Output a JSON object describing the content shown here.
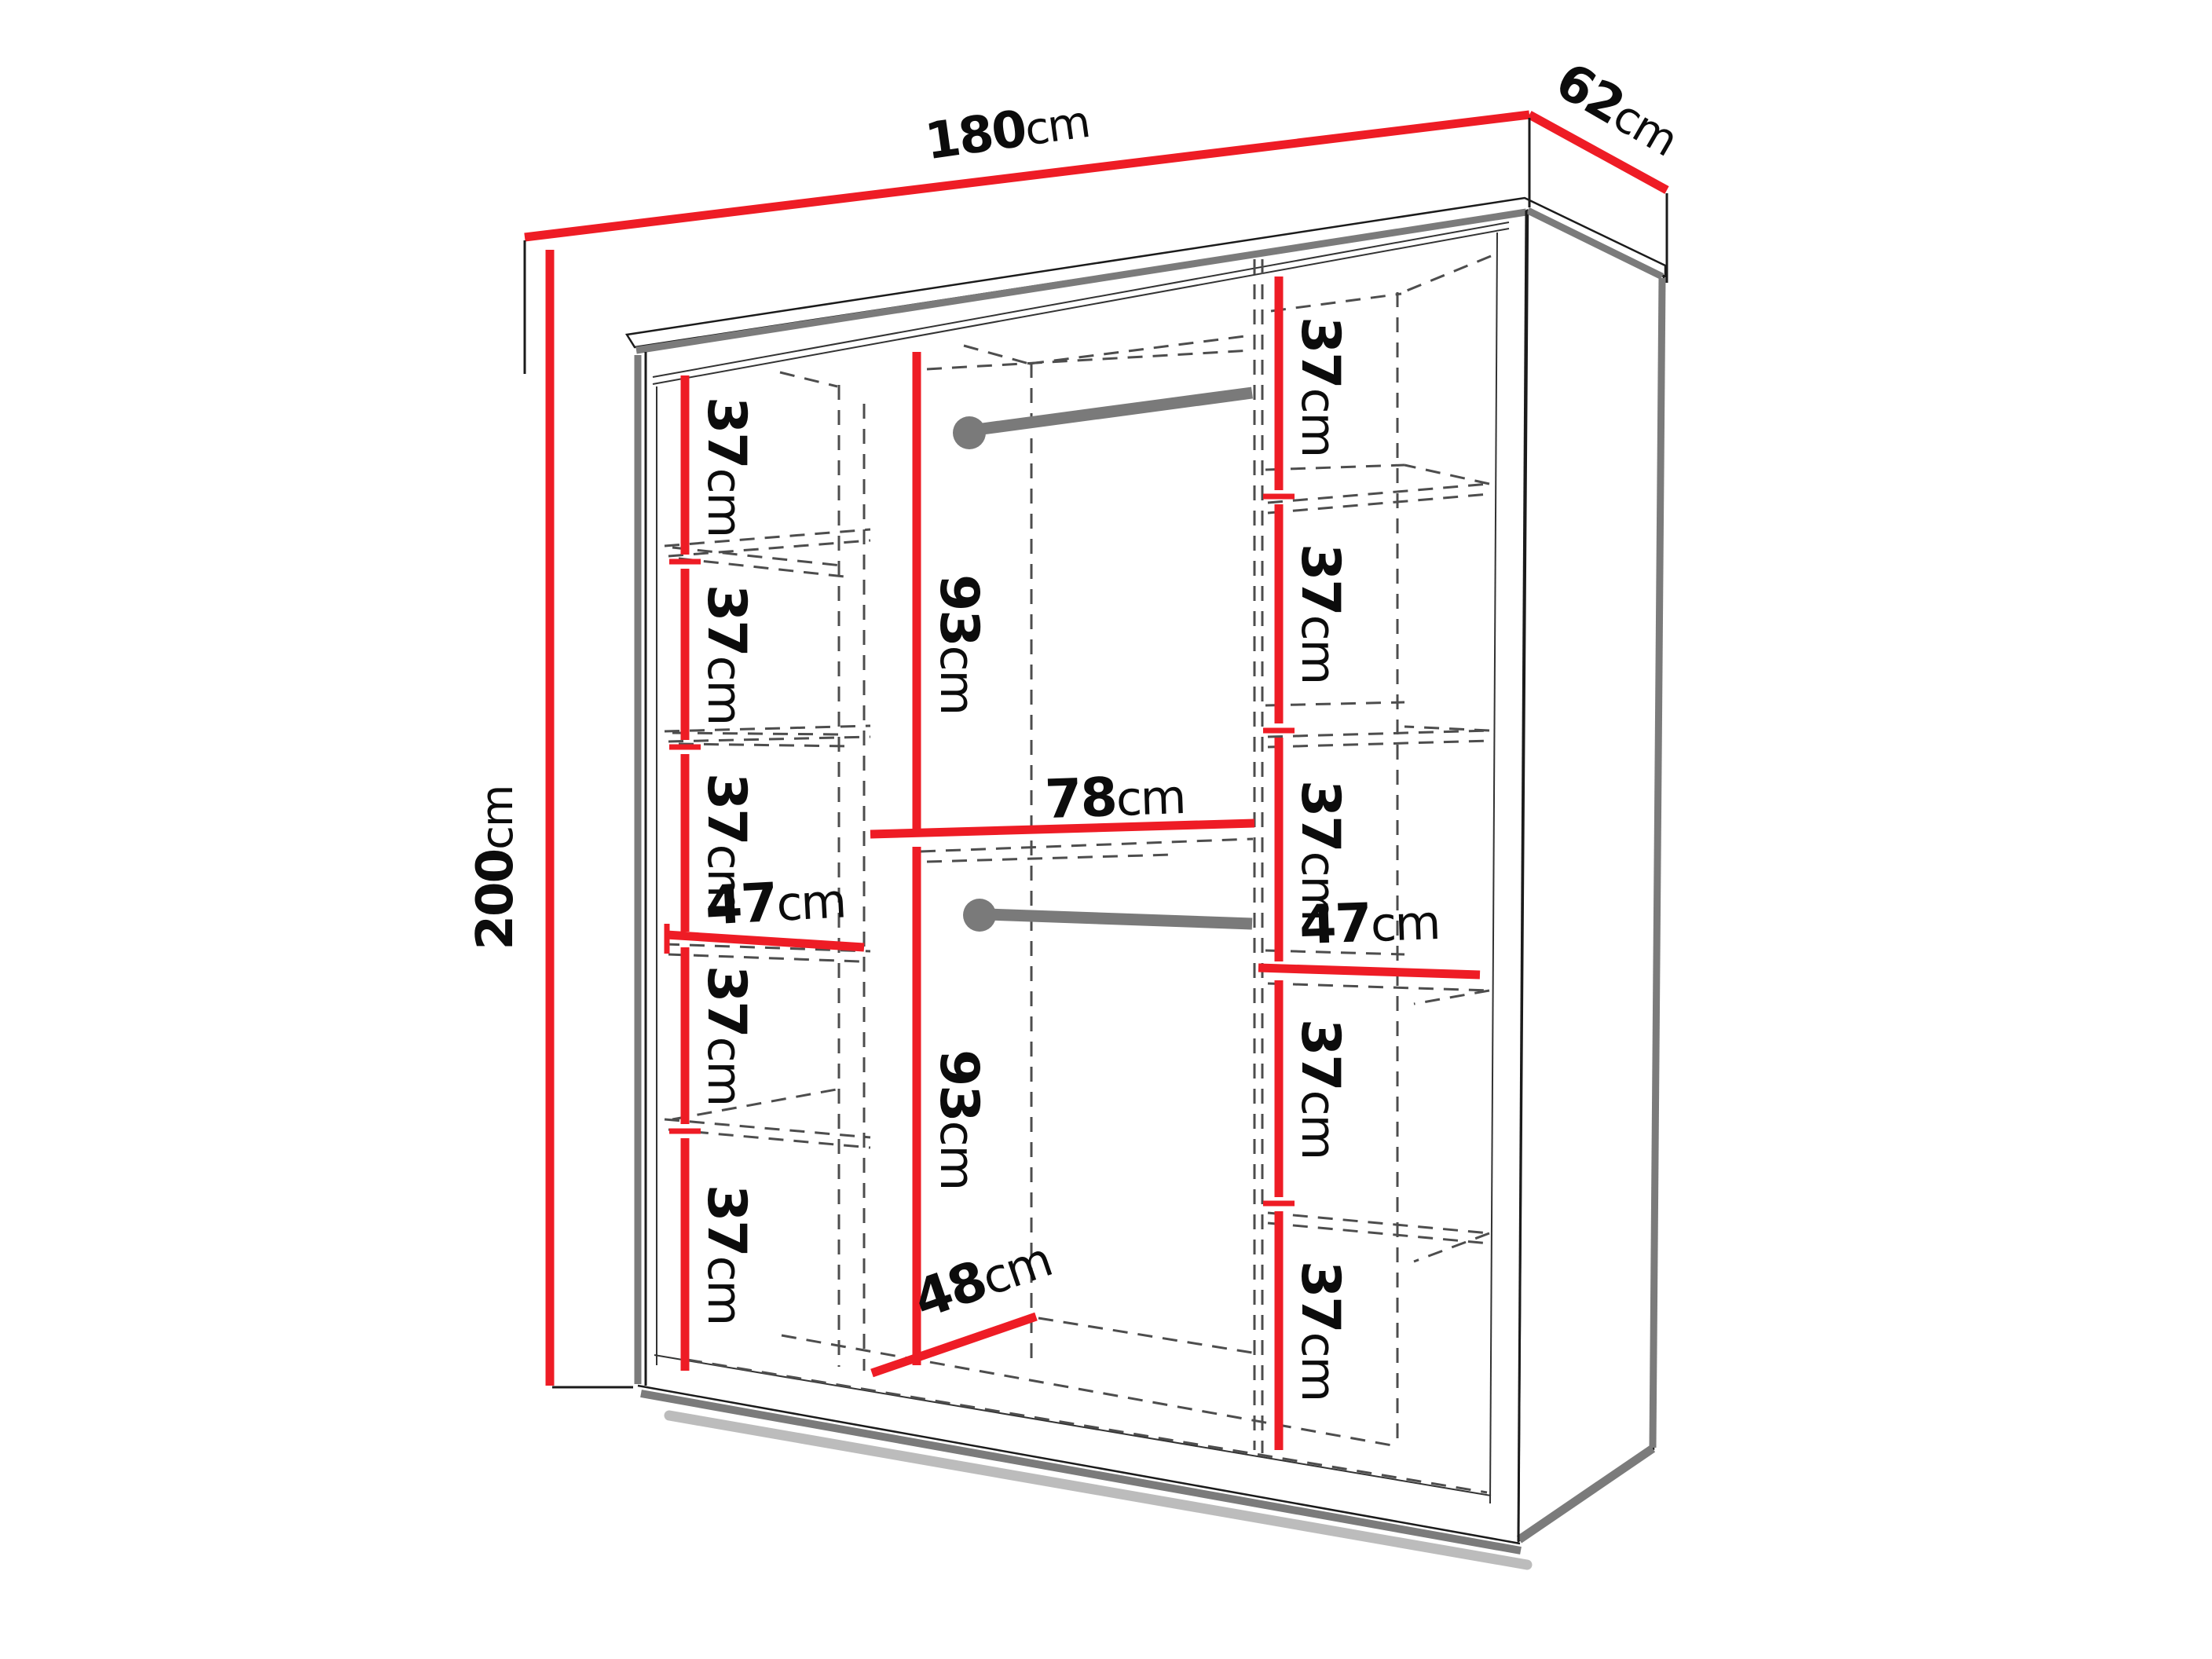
{
  "diagram": {
    "subject": "Wardrobe interior dimension diagram",
    "unit_system": "cm",
    "overall": {
      "width": {
        "value": "180",
        "unit": "cm"
      },
      "depth": {
        "value": "62",
        "unit": "cm"
      },
      "height": {
        "value": "200",
        "unit": "cm"
      }
    },
    "left_column": {
      "width": {
        "value": "47",
        "unit": "cm"
      },
      "shelf_gaps": [
        {
          "value": "37",
          "unit": "cm"
        },
        {
          "value": "37",
          "unit": "cm"
        },
        {
          "value": "37",
          "unit": "cm"
        },
        {
          "value": "37",
          "unit": "cm"
        },
        {
          "value": "37",
          "unit": "cm"
        }
      ]
    },
    "middle_column": {
      "upper_section_height": {
        "value": "93",
        "unit": "cm"
      },
      "shelf_width": {
        "value": "78",
        "unit": "cm"
      },
      "lower_section_height": {
        "value": "93",
        "unit": "cm"
      },
      "bottom_depth": {
        "value": "48",
        "unit": "cm"
      },
      "hanging_rail_count": 2
    },
    "right_column": {
      "width": {
        "value": "47",
        "unit": "cm"
      },
      "shelf_gaps": [
        {
          "value": "37",
          "unit": "cm"
        },
        {
          "value": "37",
          "unit": "cm"
        },
        {
          "value": "37",
          "unit": "cm"
        },
        {
          "value": "37",
          "unit": "cm"
        },
        {
          "value": "37",
          "unit": "cm"
        }
      ]
    },
    "colors": {
      "dimension_line": "#ee1c25",
      "edge_highlight": "#7b7b7b",
      "hidden_line": "#4d4d4d",
      "outline": "#1b1b1b"
    }
  }
}
